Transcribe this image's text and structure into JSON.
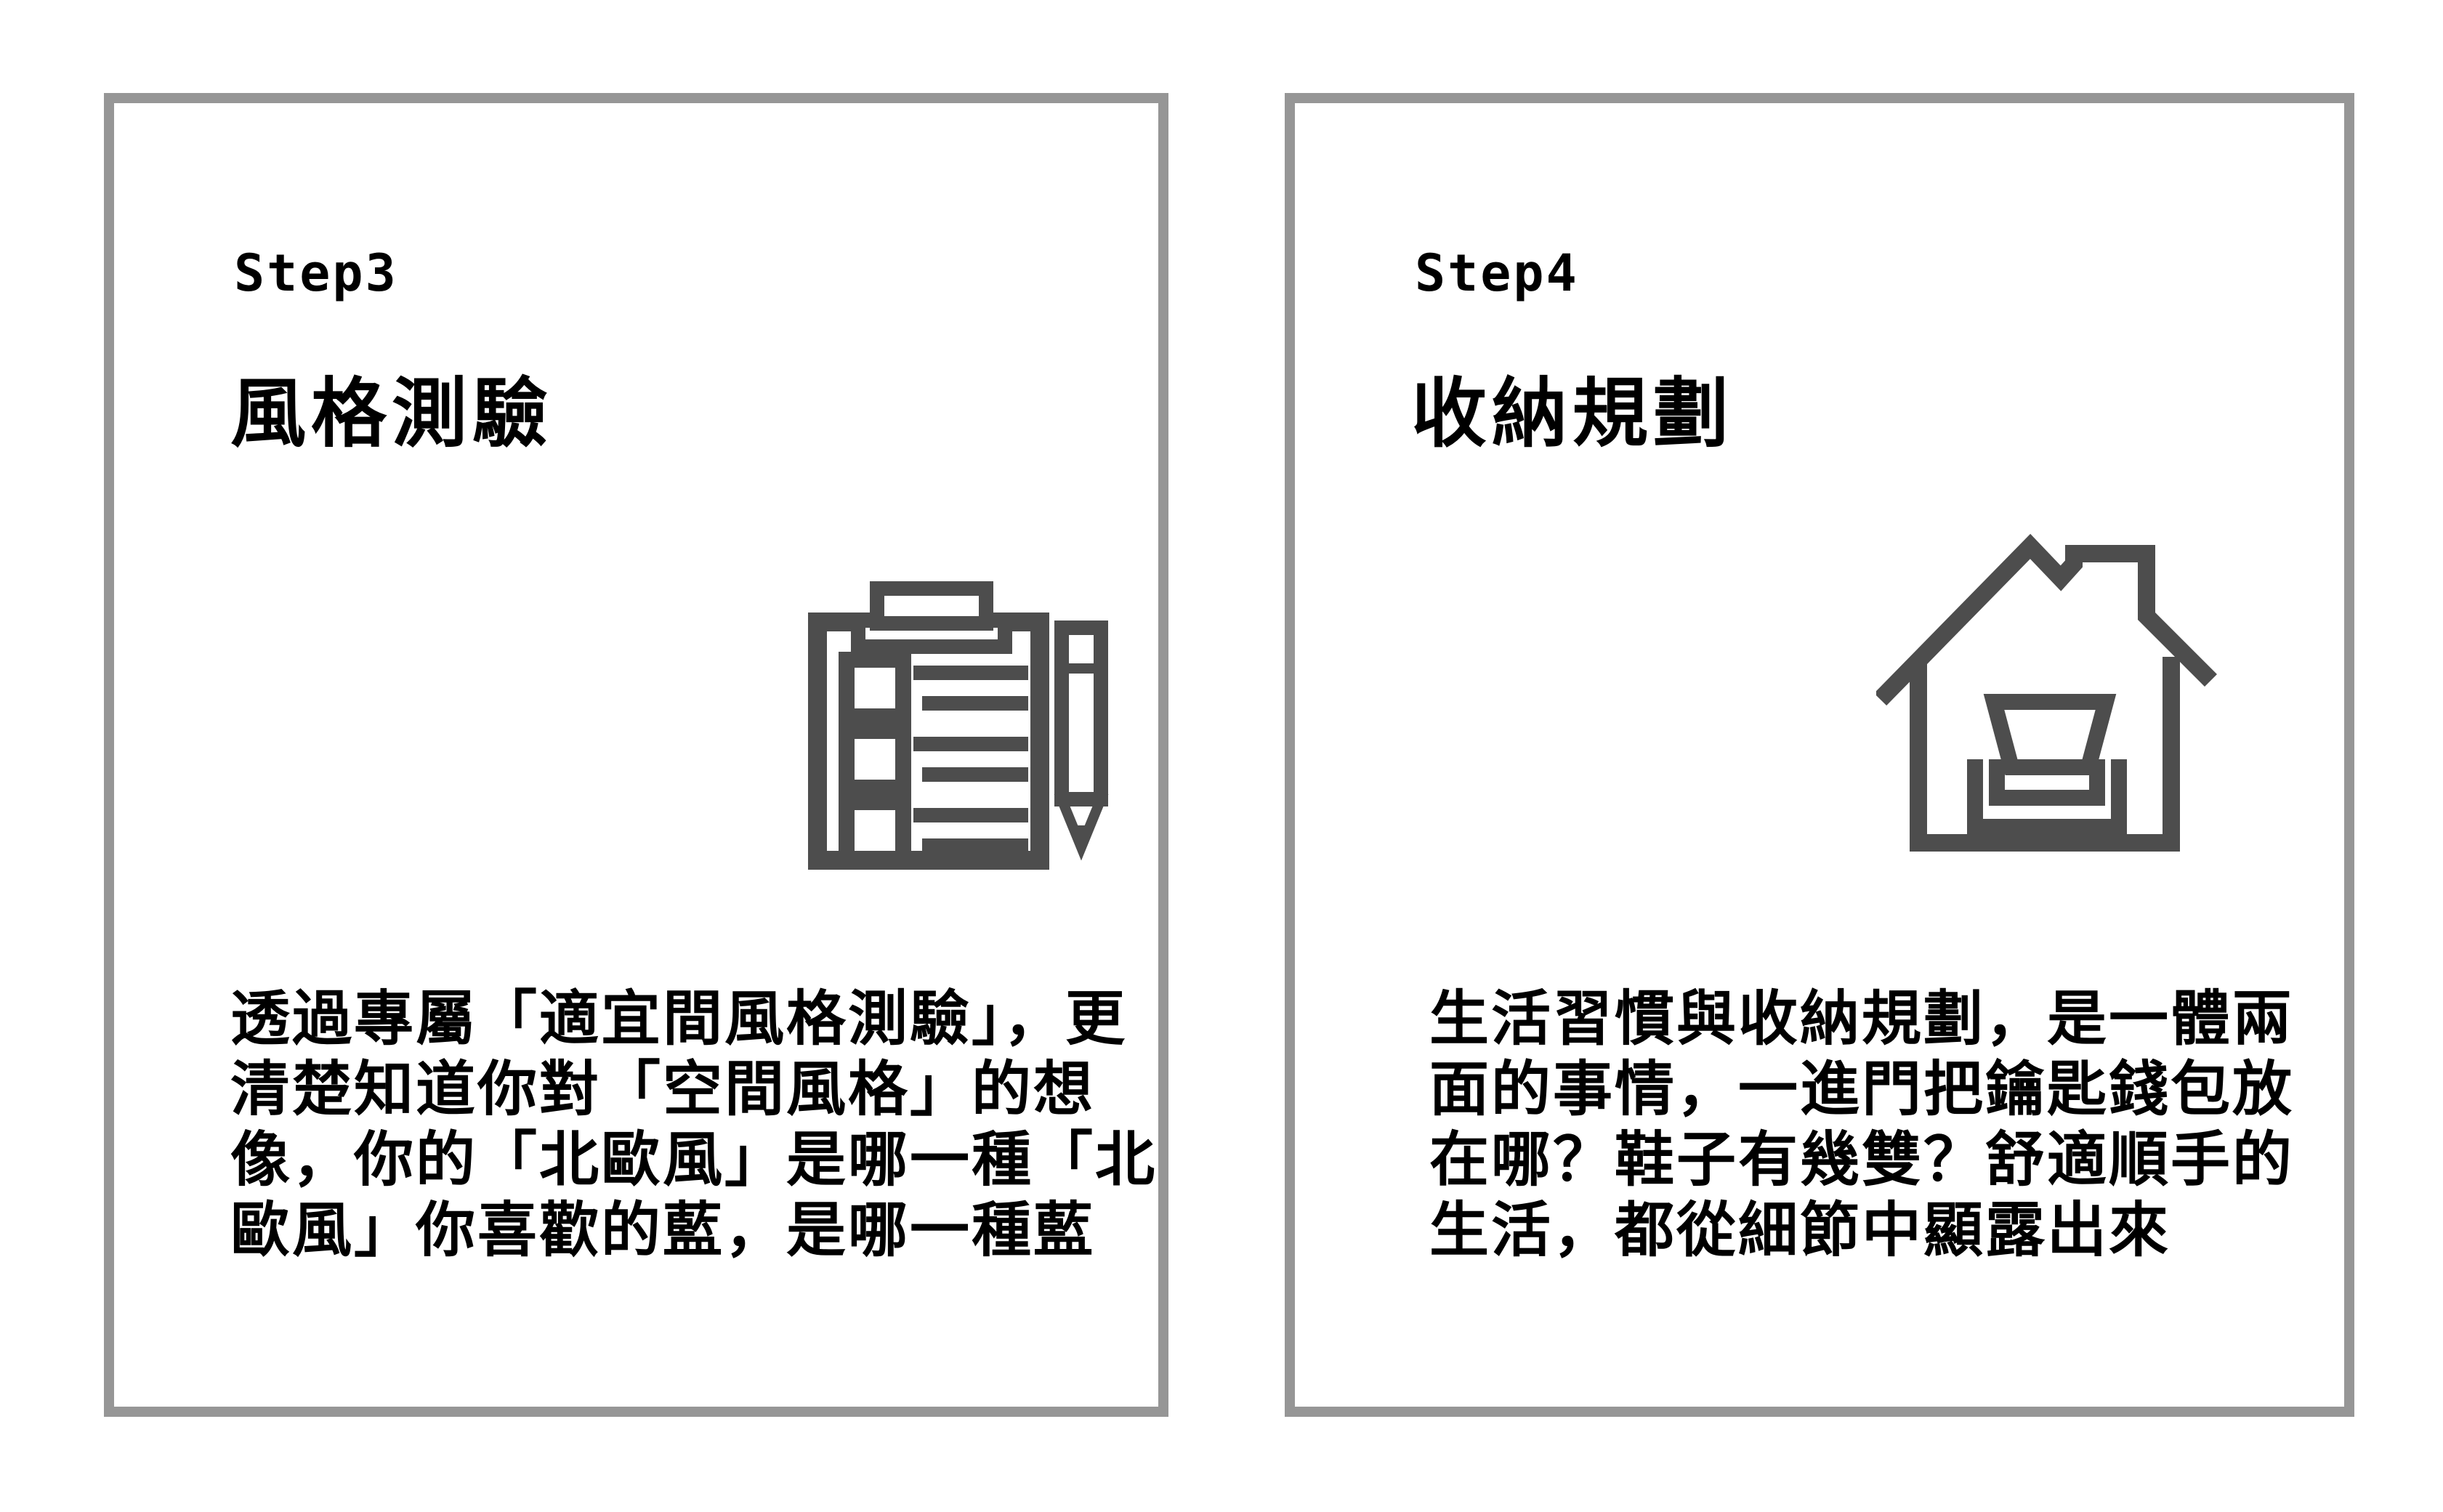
{
  "page": {
    "background": "#ffffff"
  },
  "colors": {
    "card_border": "#969696",
    "card_background": "#ffffff",
    "text": "#000000",
    "icon": "#4d4d4d"
  },
  "cards": [
    {
      "step_label": "Step3",
      "title": "風格測驗",
      "icon": "checklist-pencil-icon",
      "body_lines": [
        "透過專屬「適宜間風格測驗」，更",
        "清楚知道你對「空間風格」的想",
        "像，你的「北歐風」是哪一種「北",
        "歐風」你喜歡的藍，是哪一種藍"
      ]
    },
    {
      "step_label": "Step4",
      "title": "收納規劃",
      "icon": "house-storage-icon",
      "body_lines": [
        "生活習慣與收納規劃，是一體兩",
        "面的事情，一進門把鑰匙錢包放",
        "在哪？鞋子有幾雙？舒適順手的",
        "生活，都從細節中顯露出來"
      ]
    }
  ]
}
